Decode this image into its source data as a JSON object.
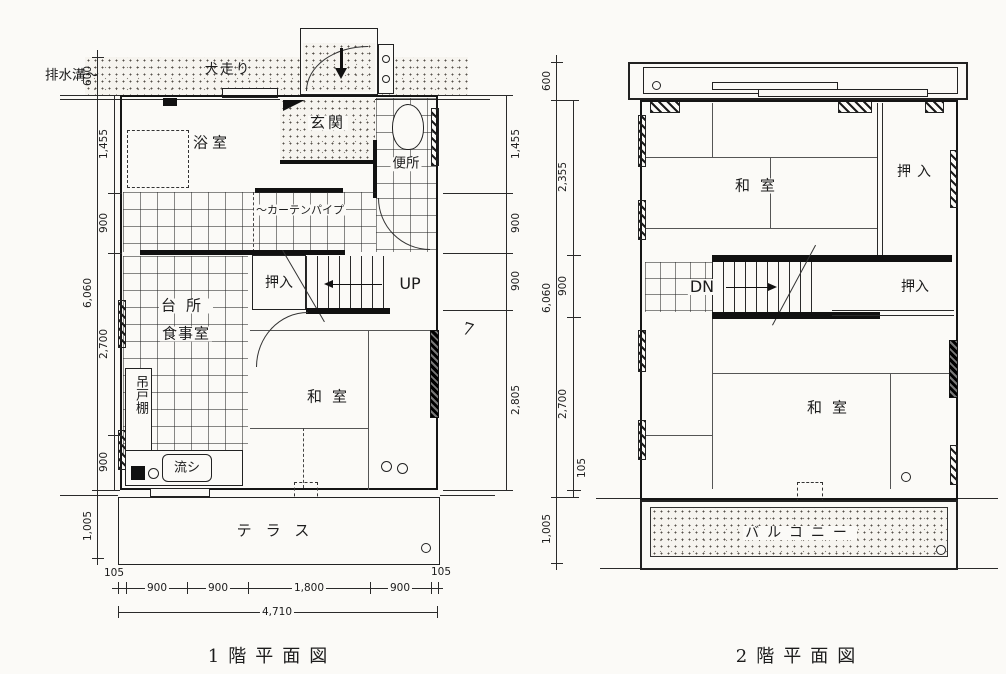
{
  "floor1": {
    "caption": "1階平面図",
    "site": {
      "drain": "排水溝〜",
      "dog_run": "犬走り"
    },
    "rooms": {
      "bath": "浴室",
      "entrance": "玄関",
      "toilet": "便所",
      "curtain_pipe": "〜カーテンパイプ",
      "closet": "押入",
      "stairs_up": "UP",
      "kitchen": "台所",
      "dining": "食事室",
      "hanging_cupboard": "吊戸棚",
      "sink": "流シ",
      "japanese_room": "和室",
      "terrace": "テラス"
    },
    "dims": {
      "top_offset": "600",
      "left_inner": [
        "1,455",
        "900",
        "2,700",
        "900"
      ],
      "left_total": "6,060",
      "left_bottom": "1,005",
      "right_inner": [
        "1,455",
        "900",
        "900",
        "2,805"
      ],
      "bottom_edge_left": "105",
      "bottom_inner": [
        "900",
        "900",
        "1,800",
        "900"
      ],
      "bottom_edge_right": "105",
      "bottom_total": "4,710"
    },
    "annotation": "7"
  },
  "floor2": {
    "caption": "2階平面図",
    "rooms": {
      "japanese_room_upper": "和室",
      "closet_upper": "押入",
      "stairs_down": "DN",
      "closet_mid": "押入",
      "japanese_room_lower": "和室",
      "balcony": "バルコニー"
    },
    "dims": {
      "top_offset": "600",
      "left_inner": [
        "2,355",
        "900",
        "2,700",
        "105"
      ],
      "left_total": "6,060",
      "left_bottom": "1,005"
    }
  }
}
